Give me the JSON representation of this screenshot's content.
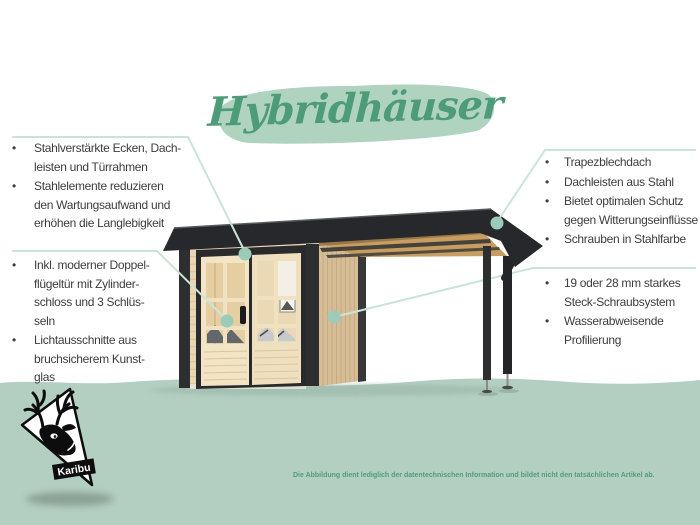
{
  "title": {
    "text": "Hybridhäuser"
  },
  "callouts": {
    "top_left": {
      "items": [
        {
          "text": "Stahlverstärkte Ecken, Dach-\nleisten und Türrahmen"
        },
        {
          "text": "Stahlelemente reduzieren\nden Wartungsaufwand und\nerhöhen die Langlebigkeit"
        }
      ]
    },
    "bottom_left": {
      "items": [
        {
          "text": "Inkl. moderner Doppel-\nflügeltür mit Zylinder-\nschloss und 3 Schlüs-\nseln"
        },
        {
          "text": "Lichtausschnitte aus\nbruchsicherem Kunst-\nglas"
        }
      ]
    },
    "top_right": {
      "items": [
        {
          "text": "Trapezblechdach"
        },
        {
          "text": "Dachleisten aus Stahl"
        },
        {
          "text": "Bietet optimalen Schutz\ngegen Witterungseinflüsse"
        },
        {
          "text": "Schrauben in Stahlfarbe"
        }
      ]
    },
    "bottom_right": {
      "items": [
        {
          "text": "19 oder 28 mm starkes\nSteck-Schraubsystem"
        },
        {
          "text": "Wasserabweisende\nProfilierung"
        }
      ]
    }
  },
  "bullet_glyph": "•",
  "logo": {
    "brand": "Karibu"
  },
  "disclaimer": {
    "text": "Die Abbildung dient lediglich der datentechnischen Information und bildet nicht den tatsächlichen Artikel ab."
  },
  "palette": {
    "background": "#ffffff",
    "ground_green": "#b3cfc1",
    "accent_green": "#4d9c77",
    "brush_green": "#b0d3c0",
    "callout_line": "#cbe4d8",
    "callout_dot": "#9ccbba",
    "text_dark": "#3d3d3d",
    "roof_dark": "#26282b",
    "wood_front": "#e9d6b4",
    "wood_door": "#f2e4c5",
    "wood_side": "#d6bd96",
    "wood_ceiling": "#c79d62"
  }
}
